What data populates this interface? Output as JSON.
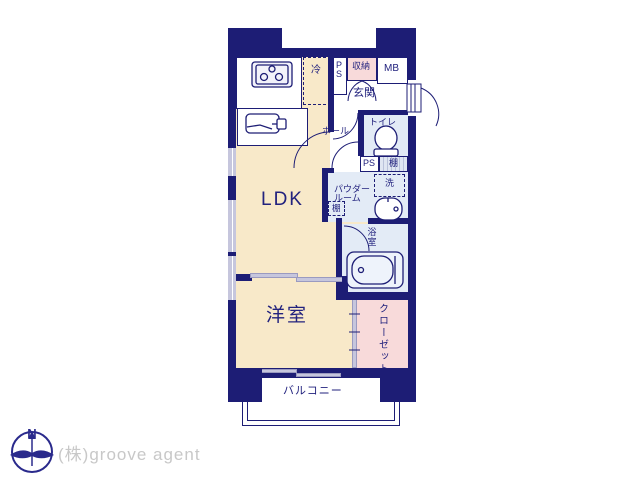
{
  "rooms": {
    "ldk": "LDK",
    "western": "洋室",
    "entrance": "玄関",
    "hall": "ホール",
    "toilet": "トイレ",
    "powder_line1": "パウダー",
    "powder_line2": "ルーム",
    "bath": "浴室",
    "closet": "クローゼット",
    "balcony": "バルコニー"
  },
  "fixtures": {
    "fridge": "冷",
    "pipe_space_top": "PS",
    "storage": "収納",
    "meter_box": "MB",
    "pipe_space_mid": "PS",
    "shelf_top": "棚",
    "washer": "洗",
    "shelf_powder": "棚"
  },
  "compass": {
    "north": "N"
  },
  "footer": {
    "company": "(株)groove agent"
  },
  "colors": {
    "wall": "#1d1d75",
    "floor_cream": "#f8e9c9",
    "wet_area_blue": "#e3ebf6",
    "storage_pink": "#f8dada",
    "window_gray": "#c6c6dd",
    "text_navy": "#22227e",
    "footer_gray": "#c8c8c8"
  }
}
